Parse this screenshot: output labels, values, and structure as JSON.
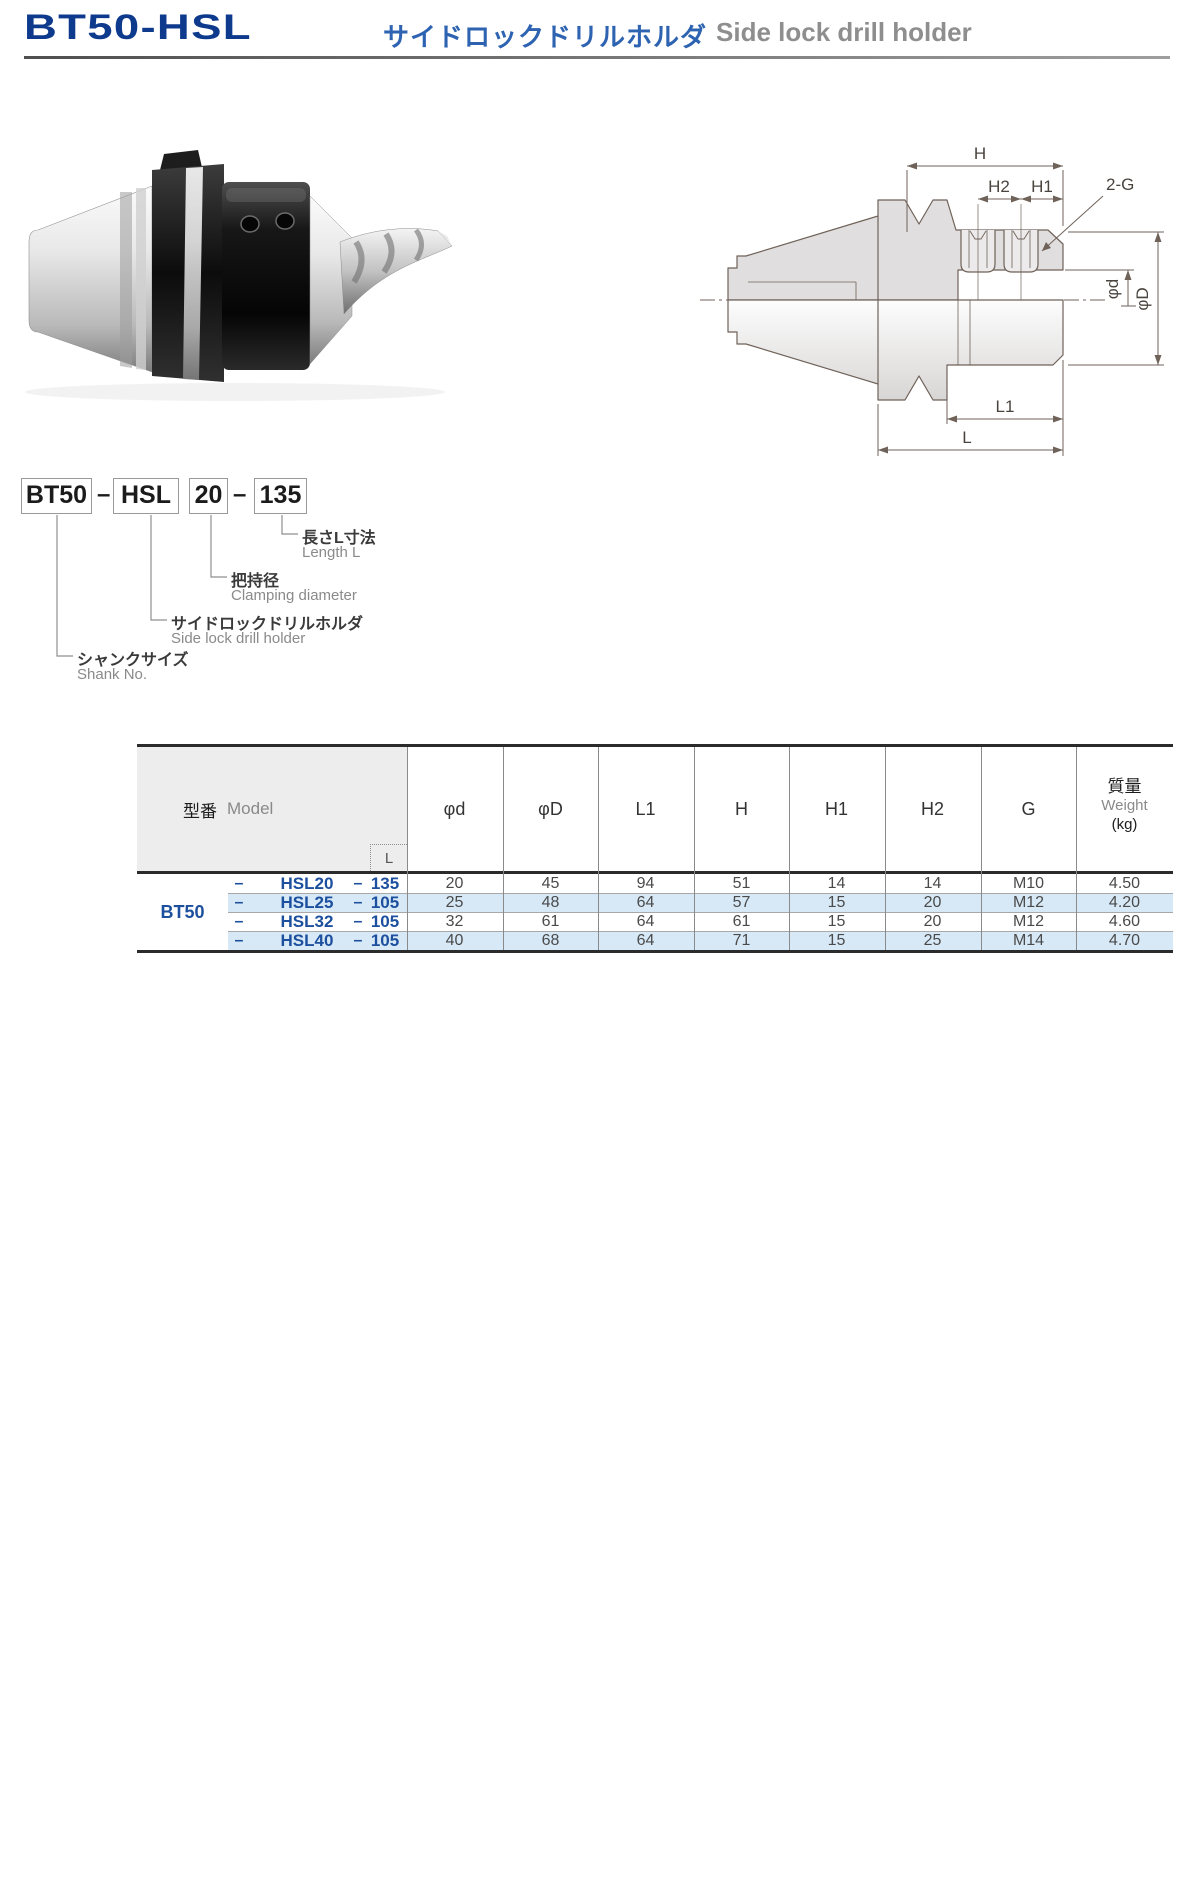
{
  "header": {
    "model": "BT50-HSL",
    "title_ja": "サイドロックドリルホルダ",
    "title_en": "Side lock drill holder"
  },
  "part_number": {
    "boxes": [
      "BT50",
      "HSL",
      "20",
      "135"
    ],
    "dash": "–",
    "callouts": [
      {
        "ja": "長さL寸法",
        "en": "Length L"
      },
      {
        "ja": "把持径",
        "en": "Clamping diameter"
      },
      {
        "ja": "サイドロックドリルホルダ",
        "en": "Side lock drill holder"
      },
      {
        "ja": "シャンクサイズ",
        "en": "Shank No."
      }
    ]
  },
  "diagram": {
    "labels": {
      "H": "H",
      "H2": "H2",
      "H1": "H1",
      "G": "2-G",
      "phid": "φd",
      "phiD": "φD",
      "L1": "L1",
      "L": "L"
    }
  },
  "table": {
    "headers": {
      "model_ja": "型番",
      "model_en": "Model",
      "l": "L",
      "weight_ja": "質量",
      "weight_en": "Weight",
      "weight_unit": "(kg)"
    },
    "dim_headers": [
      "φd",
      "φD",
      "L1",
      "H",
      "H1",
      "H2",
      "G"
    ],
    "shank": "BT50",
    "rows": [
      {
        "dash1": "–",
        "model": "HSL20",
        "dash2": "–",
        "length": "135",
        "cells": [
          "20",
          "45",
          "94",
          "51",
          "14",
          "14",
          "M10",
          "4.50"
        ]
      },
      {
        "dash1": "–",
        "model": "HSL25",
        "dash2": "–",
        "length": "105",
        "cells": [
          "25",
          "48",
          "64",
          "57",
          "15",
          "20",
          "M12",
          "4.20"
        ]
      },
      {
        "dash1": "–",
        "model": "HSL32",
        "dash2": "–",
        "length": "105",
        "cells": [
          "32",
          "61",
          "64",
          "61",
          "15",
          "20",
          "M12",
          "4.60"
        ]
      },
      {
        "dash1": "–",
        "model": "HSL40",
        "dash2": "–",
        "length": "105",
        "cells": [
          "40",
          "68",
          "64",
          "71",
          "15",
          "25",
          "M14",
          "4.70"
        ]
      }
    ]
  },
  "colors": {
    "title_navy": "#0e3a8e",
    "subtitle_blue": "#2d63b1",
    "subtitle_gray": "#8e8e8e",
    "table_blue": "#1c4f9e",
    "row_stripe": "#d7e9f7",
    "table_border_dark": "#2b2b2b",
    "drawing_line": "#6f6259"
  }
}
